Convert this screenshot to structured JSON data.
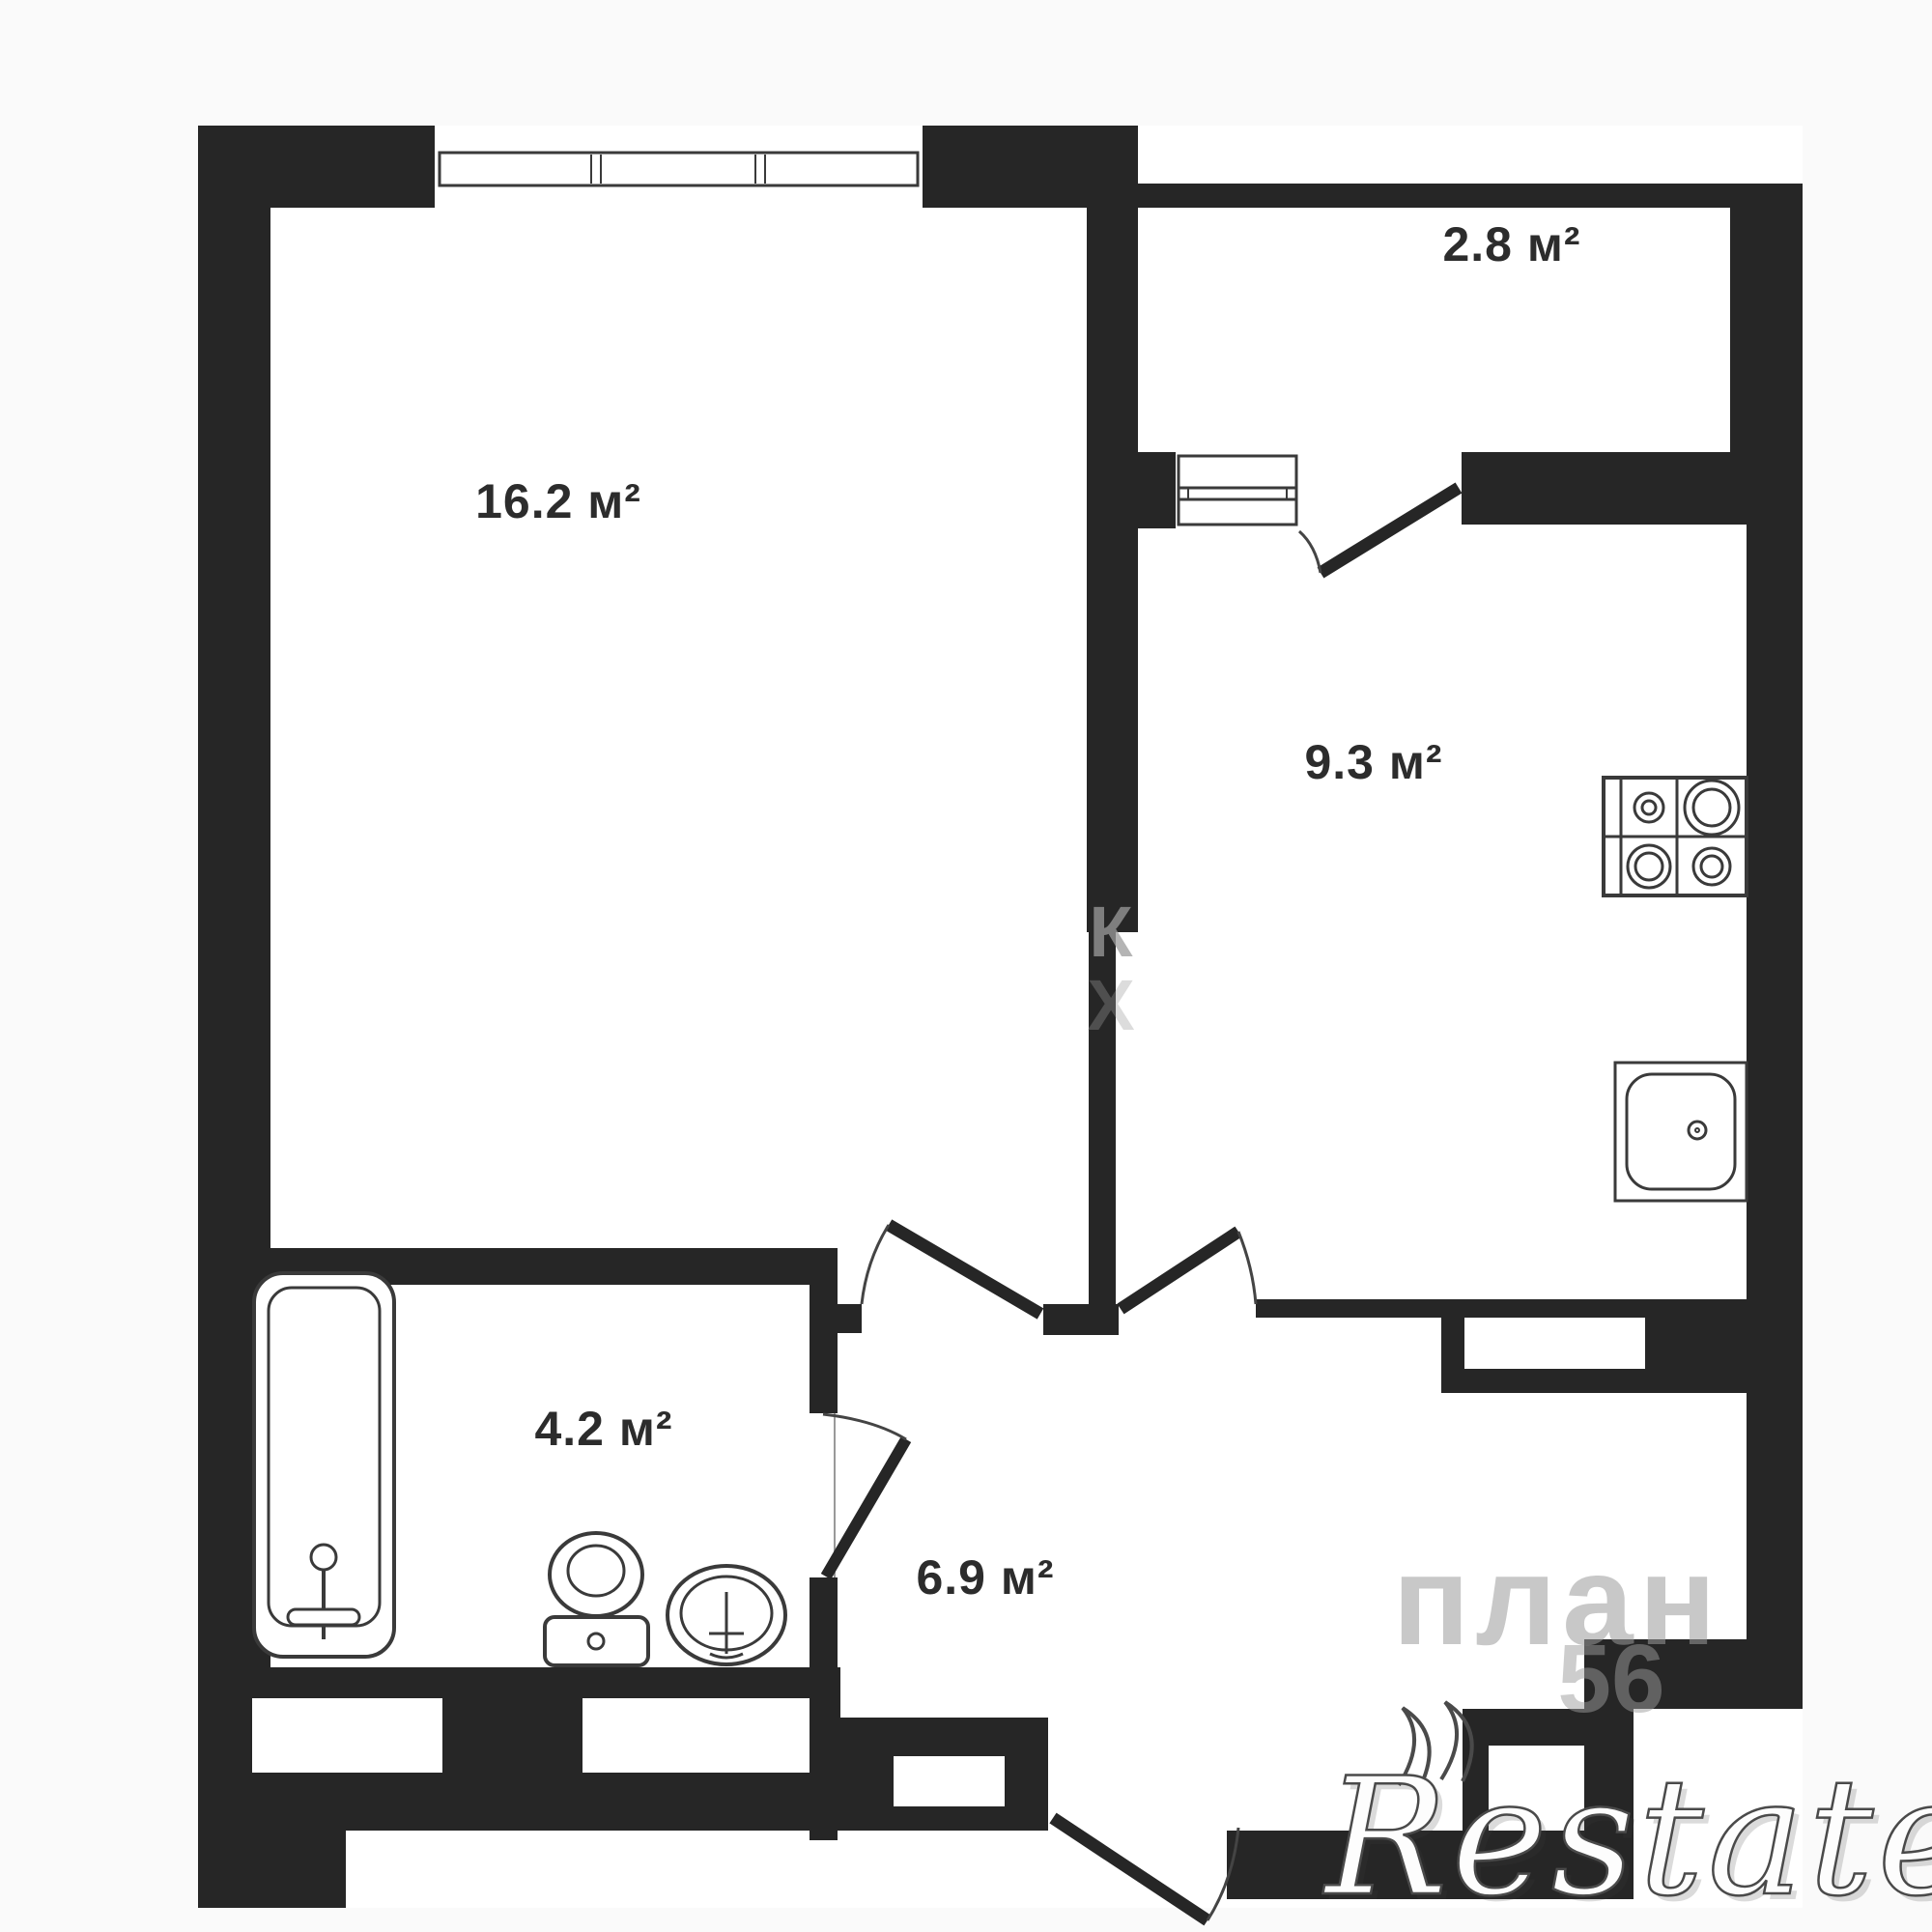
{
  "plan": {
    "background": "#fafafa",
    "floor_color": "#ffffff",
    "wall_color": "#262626",
    "line_color": "#3a3a3a",
    "label_color": "#2c2c2c",
    "rooms": [
      {
        "name": "living-room",
        "area_label": "16.2 м²"
      },
      {
        "name": "balcony",
        "area_label": "2.8 м²"
      },
      {
        "name": "kitchen",
        "area_label": "9.3 м²"
      },
      {
        "name": "bathroom",
        "area_label": "4.2 м²"
      },
      {
        "name": "hallway",
        "area_label": "6.9 м²"
      }
    ],
    "fixtures": [
      "bathtub",
      "toilet",
      "washbasin",
      "stove",
      "kitchen-sink"
    ]
  },
  "watermarks": {
    "agency_logo": "Restate",
    "site_text": "план",
    "site_number": "56",
    "stray_letter_1": "К",
    "stray_letter_2": "Х"
  }
}
